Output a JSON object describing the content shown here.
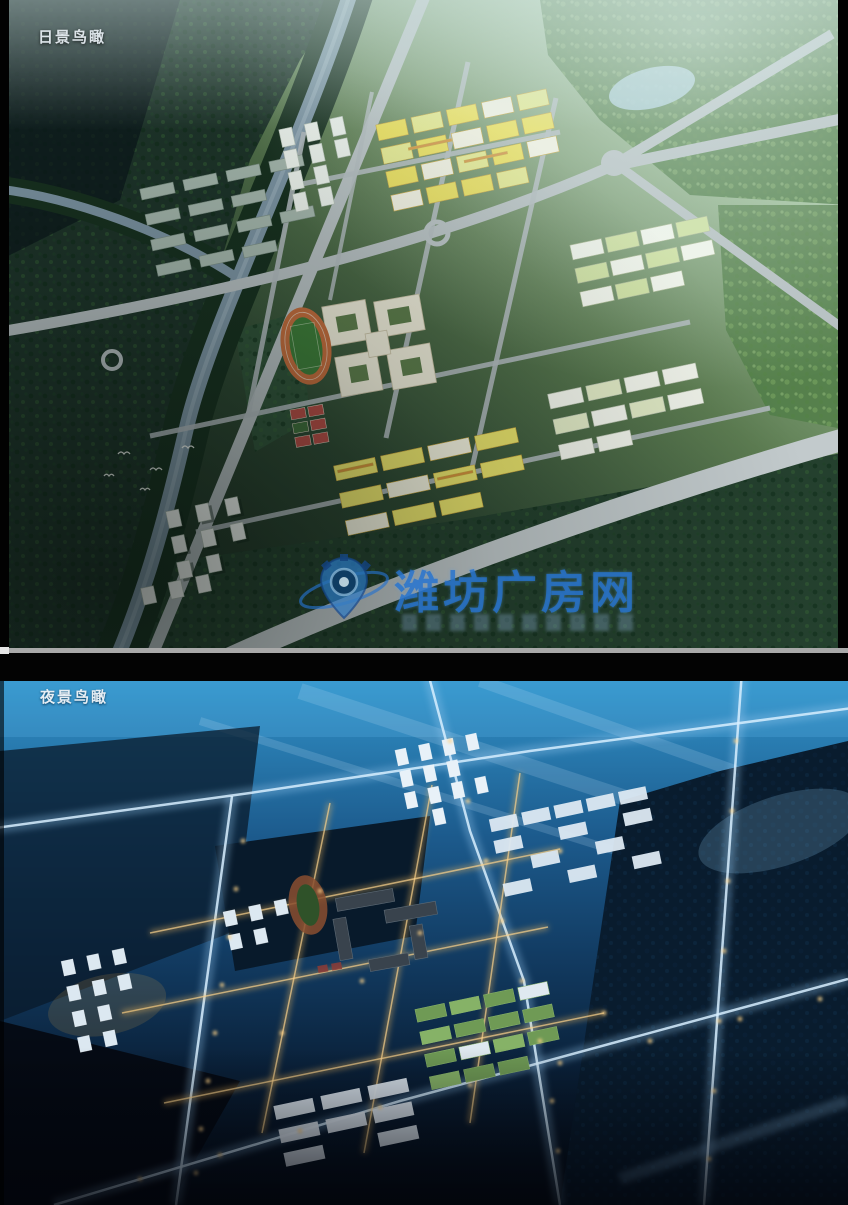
{
  "page": {
    "width_px": 848,
    "height_px": 1205
  },
  "day_view": {
    "label": "日景鸟瞰"
  },
  "night_view": {
    "label": "夜景鸟瞰"
  },
  "watermark": {
    "site_name": "潍坊广房网",
    "logo": "compass-pin-orbit-icon",
    "brand_color": "#2672cd"
  },
  "palette": {
    "label_text": "#dde4e9",
    "watermark_blue": "#2672cd",
    "divider_gray": "#a9a9a9",
    "divider_black": "#030303",
    "day_haze": "#cfe3da",
    "day_forest_dark": "#1d3329",
    "day_forest_light": "#4f7d46",
    "river_water": "#7b93a2",
    "day_road": "#b4bdbf",
    "roof_yellow": "#e9dd55",
    "roof_lime": "#e2e68a",
    "roof_white": "#eef1e8",
    "slab_gray": "#a3b5ab",
    "school_cream": "#ece4cd",
    "track_green": "#3c7a38",
    "track_lane_orange": "#bf6b3c",
    "court_red": "#b04b44",
    "night_sky_blue": "#2e8ac1",
    "night_ground": "#08121f",
    "night_road_glow": "#d7ecff",
    "night_street_warm": "#f2ba5f",
    "streetlight": "#ffd489",
    "night_roof_green": "#6f9a55",
    "night_roof_white": "#dde9f3"
  }
}
